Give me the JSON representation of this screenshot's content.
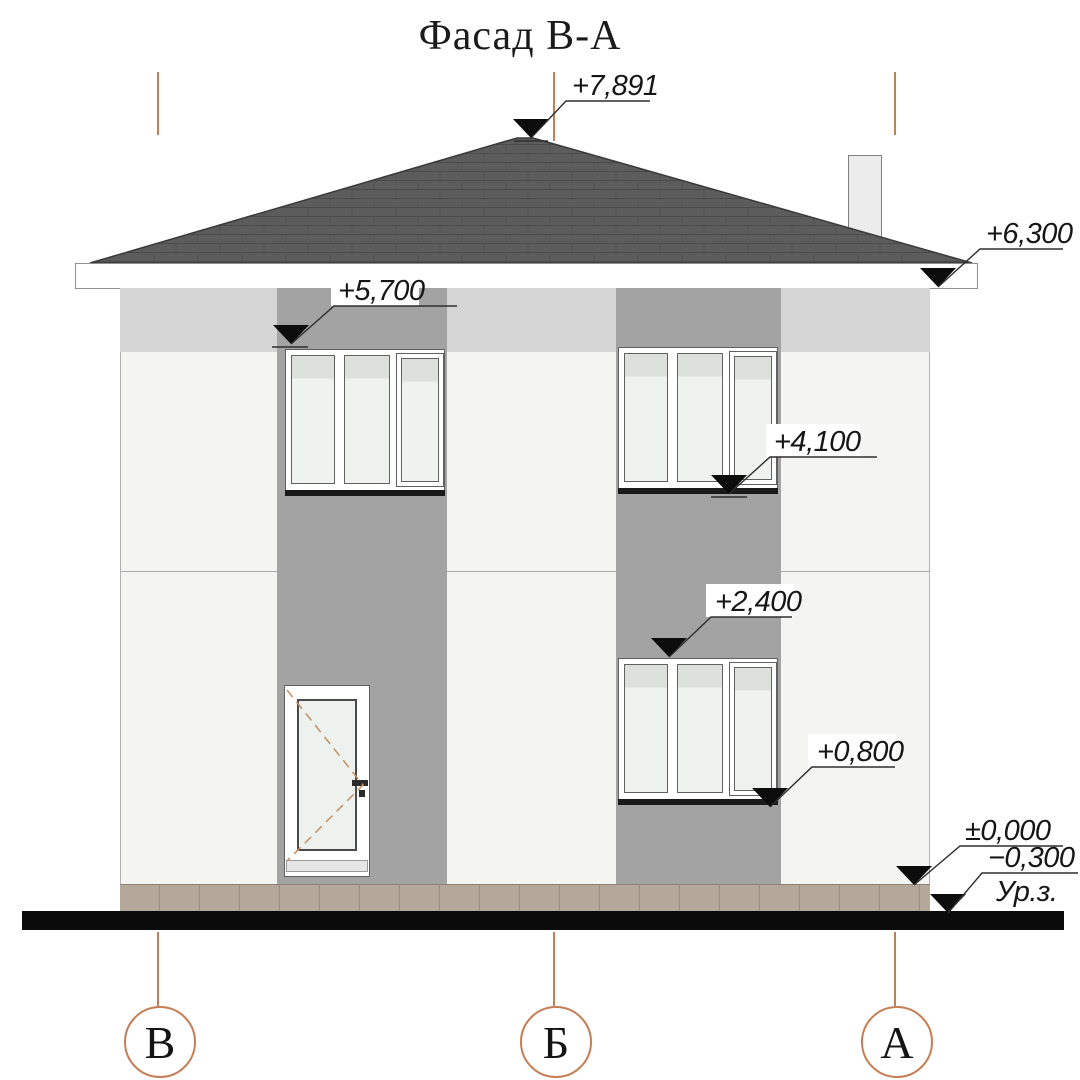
{
  "title": "Фасад В-А",
  "markers": {
    "roof_peak": "+7,891",
    "eaves_right": "+6,300",
    "upper_window_head": "+5,700",
    "upper_window_sill": "+4,100",
    "lower_window_head": "+2,400",
    "lower_window_sill": "+0,800",
    "floor_zero": "±0,000",
    "ground_level": "−0,300",
    "ground_level_label": "Ур.з."
  },
  "axes": [
    {
      "label": "В"
    },
    {
      "label": "Б"
    },
    {
      "label": "А"
    }
  ],
  "colors": {
    "roof": "#5c5c5c",
    "wall": "#f4f4f3",
    "top_band": "#d5d5d5",
    "pilaster_strip": "#a3a3a3",
    "glass": "#eef3ef",
    "plinth": "#b4a89b",
    "ground": "#0b0b0b",
    "axis_accent": "#c57e55",
    "marker_text": "#161616"
  }
}
